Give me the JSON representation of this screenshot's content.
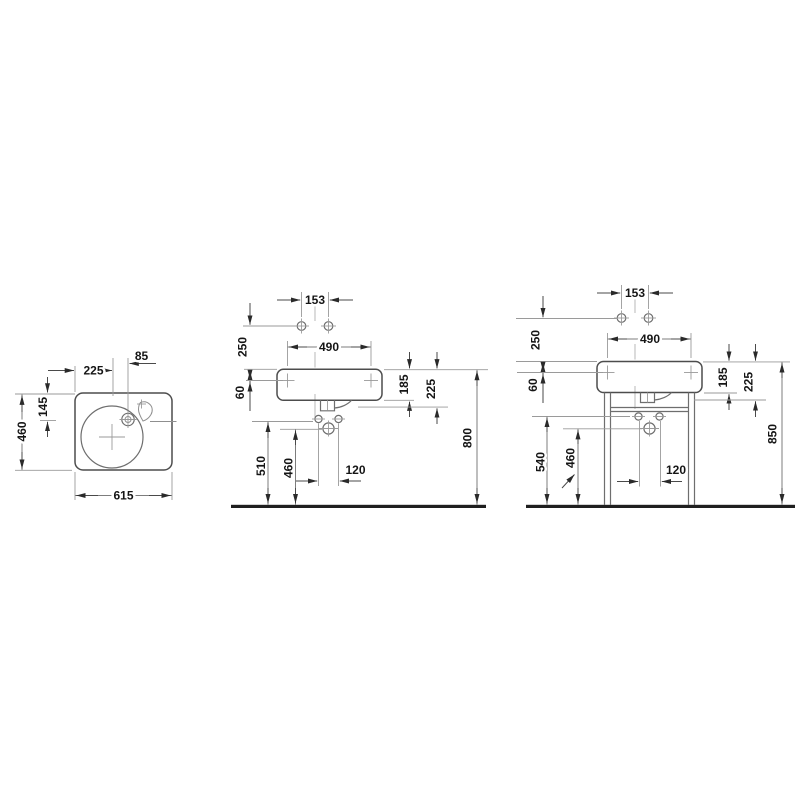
{
  "title": "Washbasin technical dimension drawing",
  "units": "mm",
  "colors": {
    "background": "#ffffff",
    "ink": "#4d4d4d",
    "dimension": "#9a9a9a",
    "text": "#151515",
    "ground": "#1f1f1f"
  },
  "top_view": {
    "offset_center": "225",
    "offset_faucet": "85",
    "faucet_depth": "145",
    "depth": "460",
    "width": "615"
  },
  "front_wall": {
    "tap_span": "153",
    "tap_height": "250",
    "fixing_span": "490",
    "fixing_drop": "60",
    "body_height": "185",
    "drain_depth": "225",
    "outlet_height": "510",
    "trap_height": "460",
    "bolt_span": "120",
    "rim_height": "800"
  },
  "front_stand": {
    "tap_span": "153",
    "tap_height": "250",
    "fixing_span": "490",
    "fixing_drop": "60",
    "body_height": "185",
    "drain_depth": "225",
    "outlet_height": "540",
    "trap_height": "460",
    "bolt_span": "120",
    "rim_height": "850"
  }
}
